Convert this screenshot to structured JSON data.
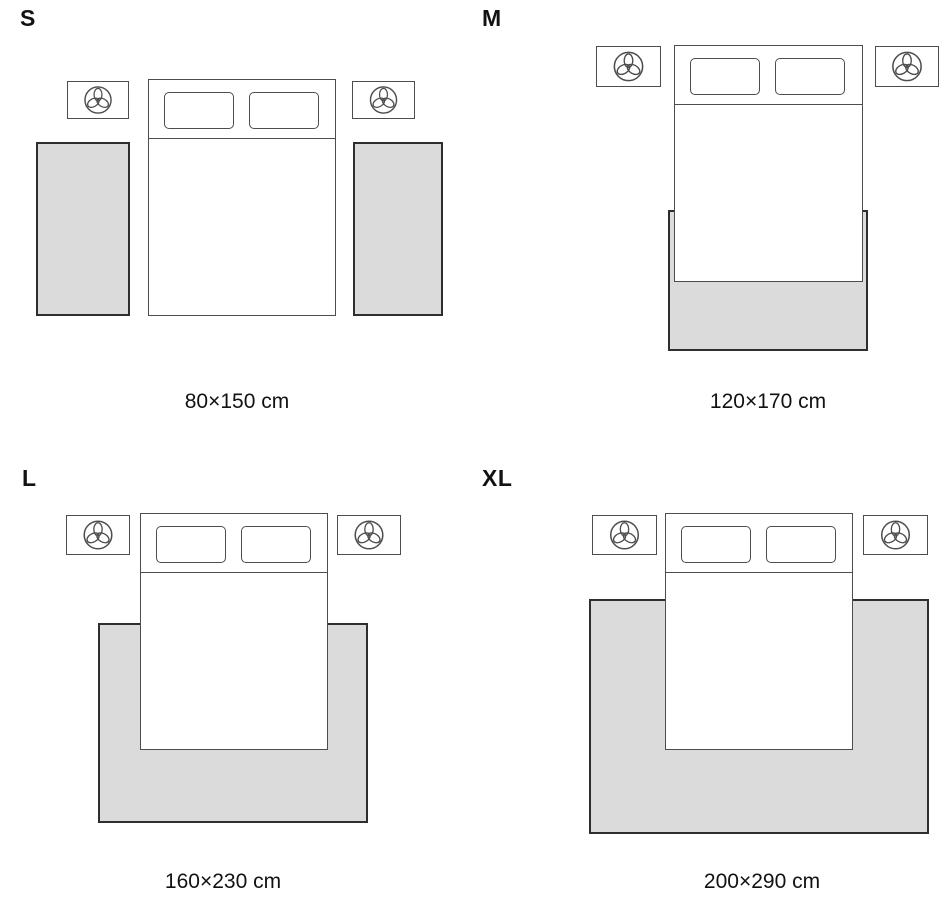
{
  "panels": [
    {
      "id": "s",
      "label": "S",
      "caption": "80×150 cm"
    },
    {
      "id": "m",
      "label": "M",
      "caption": "120×170 cm"
    },
    {
      "id": "l",
      "label": "L",
      "caption": "160×230 cm"
    },
    {
      "id": "xl",
      "label": "XL",
      "caption": "200×290 cm"
    }
  ],
  "icons": {
    "nightstand": "plant-icon"
  },
  "colors": {
    "rug_fill": "#dbdbdb",
    "rug_stroke": "#2e2e2e",
    "furniture_outline": "#4d4d4d",
    "text": "#121212",
    "background": "#ffffff"
  }
}
